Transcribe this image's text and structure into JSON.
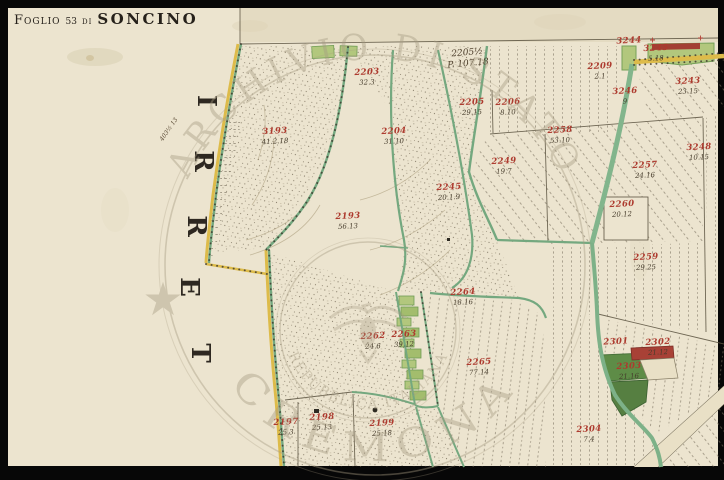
{
  "sheet": {
    "frame_color": "#070707",
    "paper_color": "#ece4cf"
  },
  "title": {
    "label_foglio": "Foglio",
    "sheet_number": "53",
    "label_di": "di",
    "place": "SONCINO"
  },
  "margin": {
    "word_read_bottom_to_top": "TERRI",
    "letters": [
      {
        "ch": "I",
        "x": 206,
        "y": 101
      },
      {
        "ch": "R",
        "x": 203,
        "y": 161
      },
      {
        "ch": "R",
        "x": 196,
        "y": 226
      },
      {
        "ch": "E",
        "x": 189,
        "y": 287
      },
      {
        "ch": "T",
        "x": 200,
        "y": 353
      }
    ]
  },
  "map_notes": {
    "survey_note_line1": "2205½",
    "survey_note_line2": "P. 107.18",
    "margin_script": "403½ 13"
  },
  "watermark": {
    "outer_top": "ARCHIVIO DI STATO",
    "outer_bottom": "CREMONA",
    "inner_ring": "REPUBBLICA ITALIANA",
    "star": "★"
  },
  "parcels": [
    {
      "id": "3193",
      "area": "41.2.18",
      "x": 275,
      "y": 136
    },
    {
      "id": "2203",
      "area": "32.3",
      "x": 367,
      "y": 77
    },
    {
      "id": "2204",
      "area": "31.10",
      "x": 394,
      "y": 136
    },
    {
      "id": "2205",
      "area": "29.15",
      "x": 472,
      "y": 107
    },
    {
      "id": "2206",
      "area": "8.10",
      "x": 508,
      "y": 107
    },
    {
      "id": "2209",
      "area": "2.1",
      "x": 600,
      "y": 71
    },
    {
      "id": "3244",
      "area": "",
      "x": 629,
      "y": 41
    },
    {
      "id": "3245",
      "area": "5.18",
      "x": 656,
      "y": 53
    },
    {
      "id": "3243",
      "area": "23.15",
      "x": 688,
      "y": 86
    },
    {
      "id": "3246",
      "area": "9",
      "x": 625,
      "y": 96
    },
    {
      "id": "3248",
      "area": "10.15",
      "x": 699,
      "y": 152
    },
    {
      "id": "2257",
      "area": "24.16",
      "x": 645,
      "y": 170
    },
    {
      "id": "2260",
      "area": "20.12",
      "x": 622,
      "y": 209
    },
    {
      "id": "2259",
      "area": "29.25",
      "x": 646,
      "y": 262
    },
    {
      "id": "2258",
      "area": "53.10",
      "x": 560,
      "y": 135
    },
    {
      "id": "2249",
      "area": "19.7",
      "x": 504,
      "y": 166
    },
    {
      "id": "2245",
      "area": "20.1.9",
      "x": 449,
      "y": 192
    },
    {
      "id": "2193",
      "area": "56.13",
      "x": 348,
      "y": 221
    },
    {
      "id": "2262",
      "area": "24.6",
      "x": 373,
      "y": 341
    },
    {
      "id": "2263",
      "area": "39.12",
      "x": 404,
      "y": 339
    },
    {
      "id": "2264",
      "area": "18.16",
      "x": 463,
      "y": 297
    },
    {
      "id": "2265",
      "area": "77.14",
      "x": 479,
      "y": 367
    },
    {
      "id": "2197",
      "area": "25.3",
      "x": 286,
      "y": 427
    },
    {
      "id": "2198",
      "area": "25.13",
      "x": 322,
      "y": 422
    },
    {
      "id": "2199",
      "area": "25.18",
      "x": 382,
      "y": 428
    },
    {
      "id": "2301",
      "area": "",
      "x": 616,
      "y": 342
    },
    {
      "id": "2302",
      "area": "21.12",
      "x": 658,
      "y": 347
    },
    {
      "id": "2303",
      "area": "21.16",
      "x": 629,
      "y": 371
    },
    {
      "id": "2304",
      "area": "7.4",
      "x": 589,
      "y": 434
    }
  ],
  "legend_colors": {
    "road_yellow": "#ddbb4a",
    "waterway_green": "#74a87f",
    "parcel_green": "#b2c77d",
    "woodland_dark_green": "#5e8c47",
    "building_red": "#a84136",
    "parcel_number_red": "#ad3a2e",
    "ink_black": "#2e2821",
    "watermark_gray": "#a69b82"
  }
}
